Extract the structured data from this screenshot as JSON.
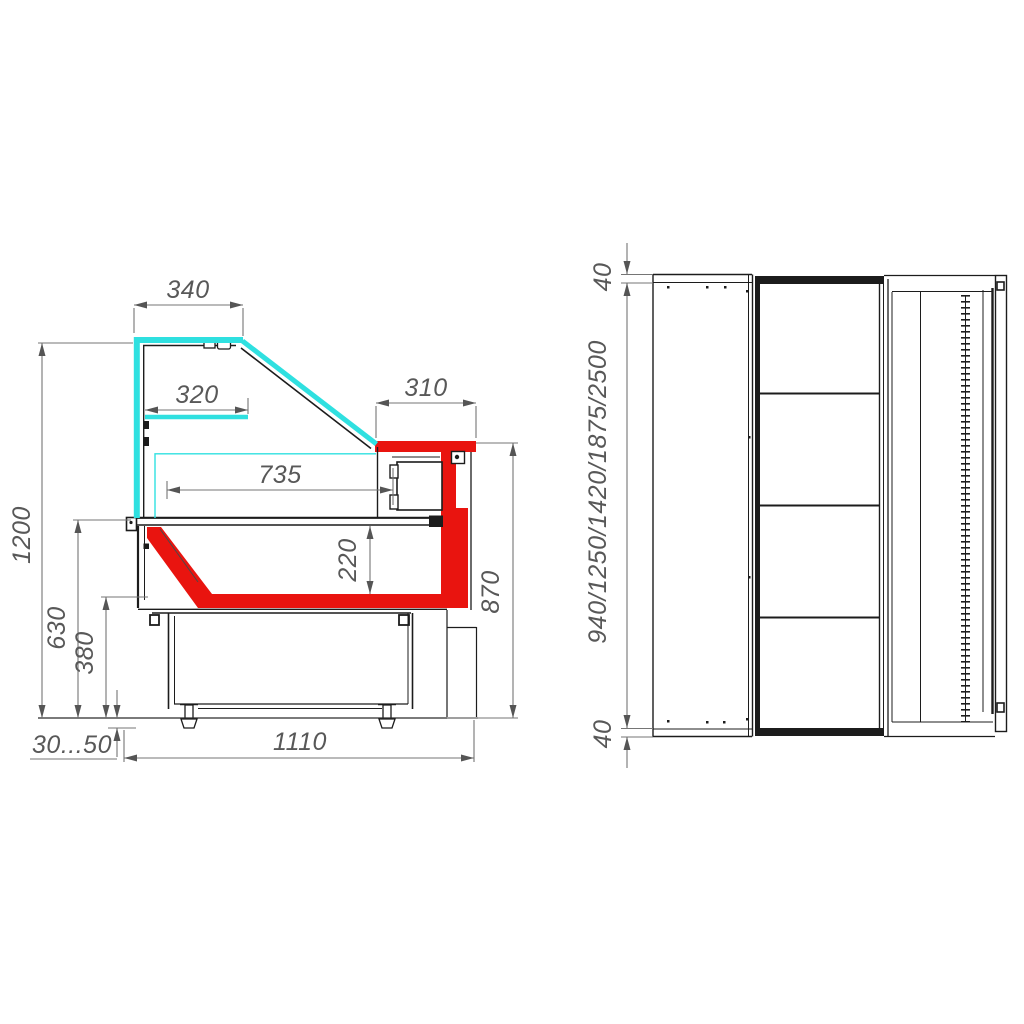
{
  "colors": {
    "glass": "#2fe0e0",
    "highlight_red": "#e9140f",
    "outline": "#1c1c1c",
    "dimension_line": "#757575",
    "dimension_text": "#585858"
  },
  "side_view": {
    "dims": {
      "canopy_width": "340",
      "shelf_width": "320",
      "rear_counter_depth": "310",
      "display_depth": "735",
      "well_height": "220",
      "overall_height": "1200",
      "deck_height": "630",
      "lower_edge_height": "380",
      "counter_height": "870",
      "foot_adjust_range": "30...50",
      "base_depth": "1110"
    }
  },
  "plan_view": {
    "dims": {
      "end_panel_top": "40",
      "end_panel_bottom": "40",
      "available_lengths": "940/1250/1420/1875/2500"
    }
  }
}
